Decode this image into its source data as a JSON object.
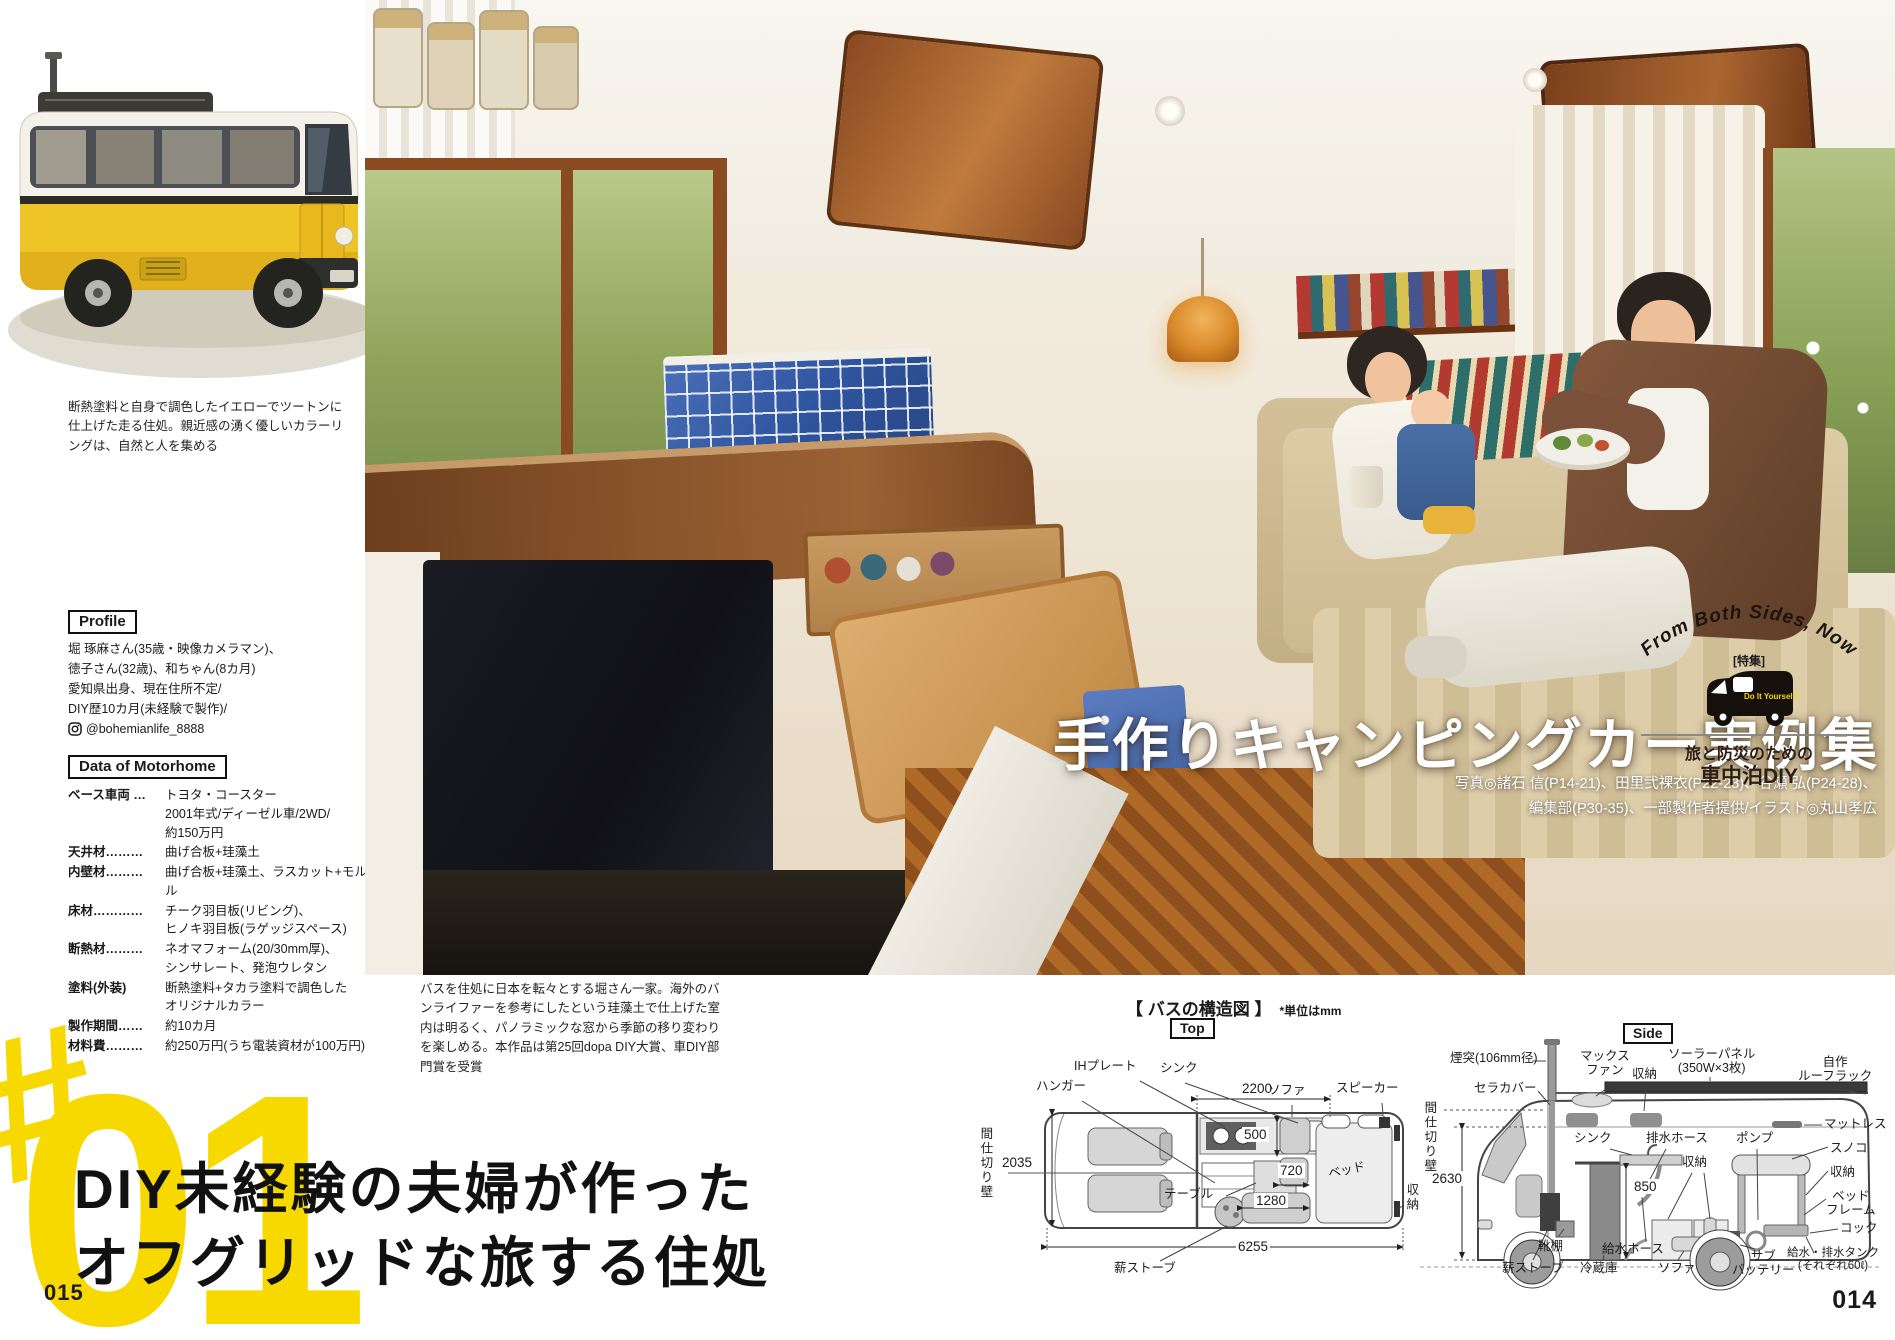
{
  "colors": {
    "accent_yellow": "#F7D900",
    "headline_black": "#111111",
    "bus_yellow": "#EFC427",
    "tile_blue": "#3A5FA8"
  },
  "page": {
    "left_page_number": "015",
    "right_page_number": "014"
  },
  "bus_photo": {
    "caption": "断熱塗料と自身で調色したイエローでツートンに仕上げた走る住処。親近感の湧く優しいカラーリングは、自然と人を集める"
  },
  "profile": {
    "header": "Profile",
    "line1": "堀 琢麻さん(35歳・映像カメラマン)、",
    "line2": "徳子さん(32歳)、和ちゃん(8カ月)",
    "line3": "愛知県出身、現在住所不定/",
    "line4": "DIY歴10カ月(未経験で製作)/",
    "instagram_handle": "@bohemianlife_8888"
  },
  "motorhome": {
    "header": "Data of Motorhome",
    "rows": [
      {
        "label": "ベース車両 …",
        "value": "トヨタ・コースター\n2001年式/ディーゼル車/2WD/\n約150万円"
      },
      {
        "label": "天井材………",
        "value": "曲げ合板+珪藻土"
      },
      {
        "label": "内壁材………",
        "value": "曲げ合板+珪藻土、ラスカット+モルタル"
      },
      {
        "label": "床材…………",
        "value": "チーク羽目板(リビング)、\nヒノキ羽目板(ラゲッジスペース)"
      },
      {
        "label": "断熱材………",
        "value": "ネオマフォーム(20/30mm厚)、\nシンサレート、発泡ウレタン"
      },
      {
        "label": "塗料(外装)",
        "value": "断熱塗料+タカラ塗料で調色した\nオリジナルカラー"
      },
      {
        "label": "製作期間……",
        "value": "約10カ月"
      },
      {
        "label": "材料費………",
        "value": "約250万円(うち電装資材が100万円)"
      }
    ]
  },
  "feature": {
    "hash": "#",
    "number": "01"
  },
  "headline": {
    "line1": "DIY未経験の夫婦が作った",
    "line2": "オフグリッドな旅する住処"
  },
  "main_photo": {
    "title": "手作りキャンピングカー実例集",
    "credits": "写真◎諸石 信(P14-21)、田里弐裸衣(P22-23)、谷瀬 弘(P24-28)、\n編集部(P30-35)、一部製作者提供/イラスト◎丸山孝広",
    "caption": "バスを住処に日本を転々とする堀さん一家。海外のバンライファーを参考にしたという珪藻土で仕上げた室内は明るく、パノラミックな窓から季節の移り変わりを楽しめる。本作品は第25回dopa DIY大賞、車DIY部門賞を受賞"
  },
  "badge": {
    "arc_text": "From Both Sides, Now",
    "tag": "[特集]",
    "van_text": "Do It Yourself!",
    "line1": "旅と防災のための",
    "line2": "車中泊DIY"
  },
  "diagram": {
    "header": "【 バスの構造図 】",
    "unit_note": "*単位はmm",
    "top": {
      "tag": "Top",
      "hanger": "ハンガー",
      "ih_plate": "IHプレート",
      "sink": "シンク",
      "sofa": "ソファ",
      "speaker": "スピーカー",
      "partition": "間仕切り壁",
      "table": "テーブル",
      "bed": "ベッド",
      "storage": "収納",
      "wood_stove": "薪ストーブ",
      "dim_2200": "2200",
      "dim_2035": "2035",
      "dim_500": "500",
      "dim_720": "720",
      "dim_1280": "1280",
      "dim_6255": "6255"
    },
    "side": {
      "tag": "Side",
      "chimney": "煙突(106mm径)",
      "cera_cover": "セラカバー",
      "max_fan": "マックス\nファン",
      "storage_roof": "収納",
      "solar_panel": "ソーラーパネル\n(350W×3枚)",
      "roof_rack": "自作\nルーフラック",
      "mattress": "マットレス",
      "sunoko": "スノコ",
      "storage_right": "収納",
      "bed_frame": "ベッド\nフレーム",
      "cock": "コック",
      "tanks": "給水・排水タンク\n(それぞれ60ℓ)",
      "sub_battery": "サブ\nバッテリー",
      "sofa": "ソファ",
      "water_hose": "給水ホース",
      "fridge": "冷蔵庫",
      "wood_stove": "薪ストーブ",
      "shoe_rack": "靴棚",
      "sink": "シンク",
      "drain_hose": "排水ホース",
      "pump": "ポンプ",
      "storage_mid": "収納",
      "partition": "間仕切り壁",
      "dim_2630": "2630",
      "dim_850": "850"
    }
  }
}
